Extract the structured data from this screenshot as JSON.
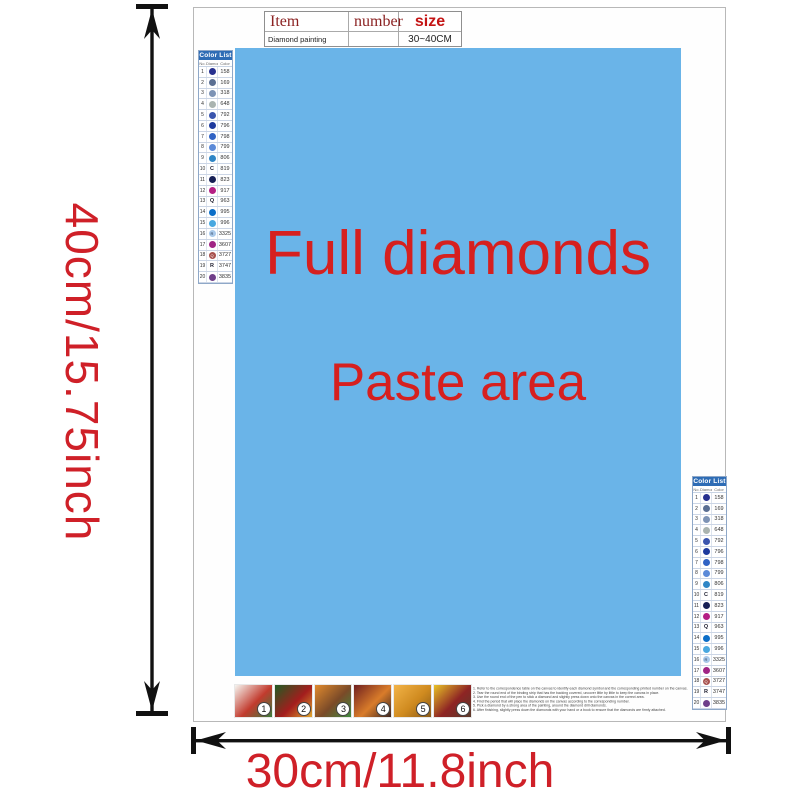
{
  "item_table": {
    "headers": [
      "Item",
      "number",
      "size"
    ],
    "row": {
      "item": "Diamond painting",
      "number": "",
      "size": "30~40CM"
    }
  },
  "paste_area": {
    "title_line1": "Full diamonds",
    "title_line2": "Paste area",
    "bg_color": "#6ab4e8",
    "text_color": "#d6201f"
  },
  "color_list": {
    "title": "Color List",
    "columns": [
      "No.",
      "Diamond",
      "Color"
    ],
    "header_bg": "#2e6cb5",
    "rows": [
      {
        "no": "1",
        "symbol": "",
        "circle": "#26308f",
        "code": "158"
      },
      {
        "no": "2",
        "symbol": "",
        "circle": "#5a6f93",
        "code": "169"
      },
      {
        "no": "3",
        "symbol": "",
        "circle": "#7d93b5",
        "code": "318"
      },
      {
        "no": "4",
        "symbol": "",
        "circle": "#aab4b0",
        "code": "648"
      },
      {
        "no": "5",
        "symbol": "",
        "circle": "#3a55ae",
        "code": "792"
      },
      {
        "no": "6",
        "symbol": "",
        "circle": "#1d3a9e",
        "code": "796"
      },
      {
        "no": "7",
        "symbol": "",
        "circle": "#2f62c4",
        "code": "798"
      },
      {
        "no": "8",
        "symbol": "",
        "circle": "#5b8ad8",
        "code": "799"
      },
      {
        "no": "9",
        "symbol": "",
        "circle": "#2f86c6",
        "code": "806"
      },
      {
        "no": "10",
        "symbol": "C",
        "circle": "",
        "code": "819"
      },
      {
        "no": "11",
        "symbol": "",
        "circle": "#161f55",
        "code": "823"
      },
      {
        "no": "12",
        "symbol": "",
        "circle": "#b51f84",
        "code": "917"
      },
      {
        "no": "13",
        "symbol": "Q",
        "circle": "",
        "code": "963"
      },
      {
        "no": "14",
        "symbol": "",
        "circle": "#0b6ec8",
        "code": "995"
      },
      {
        "no": "15",
        "symbol": "",
        "circle": "#49a8e0",
        "code": "996"
      },
      {
        "no": "16",
        "symbol": "R",
        "circle": "#a9c9ea",
        "symbol_color": "#2a3a55",
        "code": "3325"
      },
      {
        "no": "17",
        "symbol": "",
        "circle": "#a02585",
        "code": "3607"
      },
      {
        "no": "18",
        "symbol": "Q",
        "circle": "#a8524f",
        "code": "3727"
      },
      {
        "no": "19",
        "symbol": "R",
        "circle": "",
        "code": "3747"
      },
      {
        "no": "20",
        "symbol": "",
        "circle": "#6f3f8a",
        "code": "3835"
      }
    ]
  },
  "steps": [
    {
      "num": "1",
      "colors": [
        "#f5f5f0",
        "#c23b2e",
        "#3a7d3b"
      ]
    },
    {
      "num": "2",
      "colors": [
        "#1f5c23",
        "#a31d1d",
        "#e0a62e"
      ]
    },
    {
      "num": "3",
      "colors": [
        "#e08a2e",
        "#7a4a28",
        "#3f8a3f"
      ]
    },
    {
      "num": "4",
      "colors": [
        "#6e1f1f",
        "#d97c2a",
        "#3a2420"
      ]
    },
    {
      "num": "5",
      "colors": [
        "#f2b347",
        "#cf8a1f",
        "#8a5a17"
      ]
    },
    {
      "num": "6",
      "colors": [
        "#e8c226",
        "#8e2424",
        "#5a3a2a"
      ]
    }
  ],
  "instructions": [
    "1. Refer to the correspondence table on the canvas to identify each diamond symbol and the corresponding printed number on the canvas.",
    "2. Tear the round end of the binding strip that has the backing covered, uncover little by little to keep the canvas in place.",
    "3. Use the round end of the pen to stick a diamond and slightly press down onto the canvas in the correct area.",
    "4. Find the period that will place the diamonds on the canvas according to the corresponding number.",
    "5. Pick a diamond by a strong area of the painting, around the diamond drill diamonds.",
    "6. After finishing, slightly press down the diamonds with your hand or a book to ensure that the diamonds are firmly attached."
  ],
  "dimensions": {
    "height_label": "40cm/15.75inch",
    "width_label": "30cm/11.8inch",
    "label_color": "#cf2028"
  }
}
